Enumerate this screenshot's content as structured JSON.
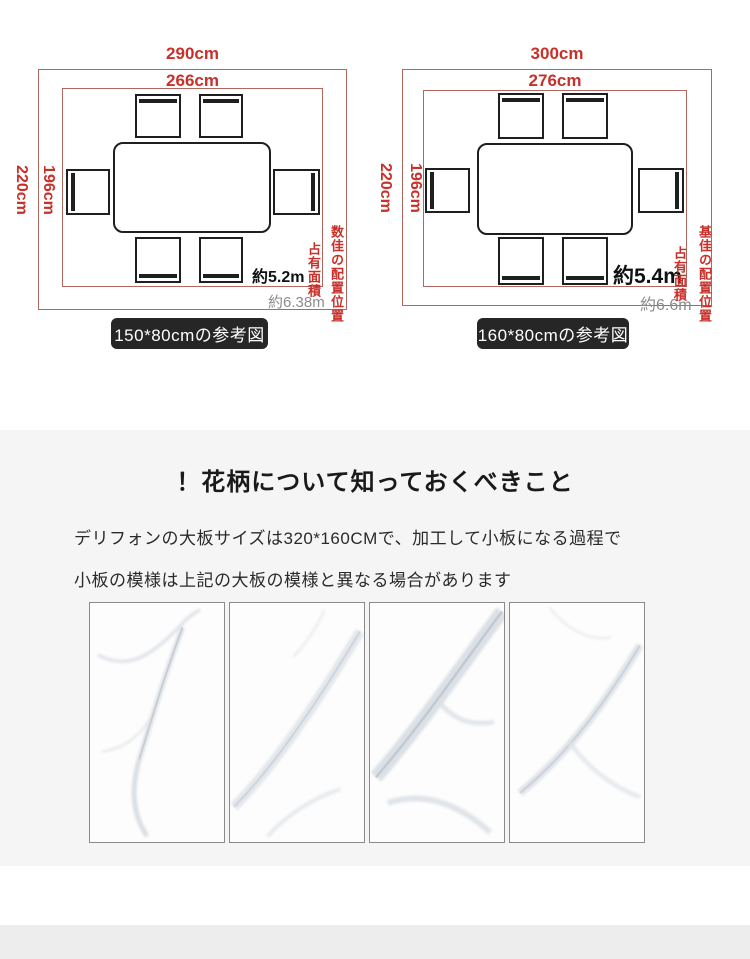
{
  "diagrams": [
    {
      "outer_width": "290cm",
      "inner_width": "266cm",
      "outer_height": "220cm",
      "inner_height": "196cm",
      "length_note": "約5.2m",
      "area_note": "約6.38m",
      "caption_area": "占有面積",
      "caption_position": "数佳の配置位置",
      "size_label": "150*80cmの参考図"
    },
    {
      "outer_width": "300cm",
      "inner_width": "276cm",
      "outer_height": "220cm",
      "inner_height": "196cm",
      "length_note": "約5.4m",
      "area_note": "約6.6m",
      "caption_area": "占有面積",
      "caption_position": "基佳の配置位置",
      "size_label": "160*80cmの参考図"
    }
  ],
  "info": {
    "title": "！花柄について知っておくべきこと",
    "line1": "デリフォンの大板サイズは320*160CMで、加工して小板になる過程で",
    "line2": "小板の模様は上記の大板の模様と異なる場合があります"
  },
  "colors": {
    "dimension_red": "#c9302a",
    "outline_red": "#b2675e",
    "ink": "#1f1f1f",
    "muted_gray": "#8c8c8c",
    "pill_bg": "#262626",
    "section_bg": "#f5f5f5",
    "footer_bg": "#ededed"
  }
}
